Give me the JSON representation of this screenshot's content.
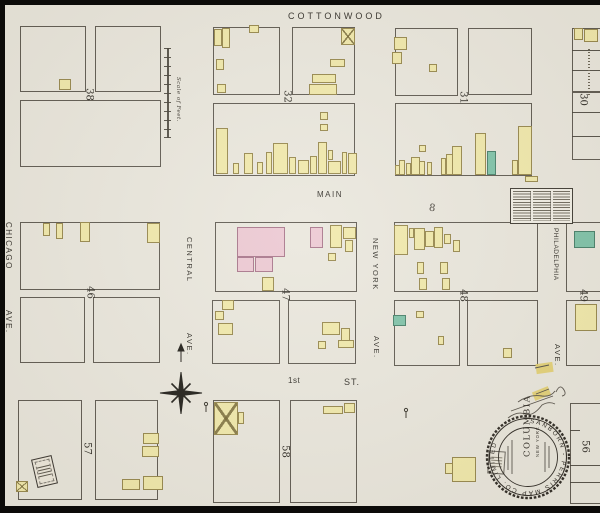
{
  "map": {
    "streets": {
      "cottonwood": "COTTONWOOD",
      "main": "MAIN",
      "first_number": "1st",
      "first_st": "ST.",
      "chicago": "CHICAGO",
      "chicago_ave": "AVE.",
      "central": "CENTRAL",
      "central_ave": "AVE.",
      "new_york": "NEW YORK",
      "new_york_ave": "AVE.",
      "philadelphia": "PHILADELPHIA",
      "philadelphia_ave": "AVE."
    },
    "scale_label": "Scale of Feet.",
    "stamp": {
      "ring_text": "SANBORN - PERRIS MAP CO. LIMITED",
      "city": "COLUMBIA",
      "sub": "NEW YORK"
    },
    "annotations": {
      "mark_eight": "8"
    },
    "colors": {
      "paper": "#eae7dd",
      "building_yellow": "#f1e9ab",
      "building_pink": "#ecc8d2",
      "building_green": "#7fc3a9",
      "line": "#46413a"
    },
    "block_numbers": [
      {
        "label": "38",
        "x": 82,
        "y": 89
      },
      {
        "label": "32",
        "x": 280,
        "y": 91
      },
      {
        "label": "31",
        "x": 456,
        "y": 92
      },
      {
        "label": "30",
        "x": 576,
        "y": 94
      },
      {
        "label": "46",
        "x": 83,
        "y": 287
      },
      {
        "label": "47",
        "x": 278,
        "y": 289
      },
      {
        "label": "48",
        "x": 456,
        "y": 290
      },
      {
        "label": "49",
        "x": 576,
        "y": 290
      },
      {
        "label": "57",
        "x": 80,
        "y": 443
      },
      {
        "label": "58",
        "x": 278,
        "y": 446
      },
      {
        "label": "56",
        "x": 578,
        "y": 441
      }
    ],
    "lots": [
      {
        "x": 20,
        "y": 26,
        "w": 66,
        "h": 66
      },
      {
        "x": 95,
        "y": 26,
        "w": 66,
        "h": 66
      },
      {
        "x": 20,
        "y": 100,
        "w": 141,
        "h": 67
      },
      {
        "x": 213,
        "y": 27,
        "w": 67,
        "h": 68
      },
      {
        "x": 292,
        "y": 27,
        "w": 63,
        "h": 68
      },
      {
        "x": 213,
        "y": 103,
        "w": 142,
        "h": 73
      },
      {
        "x": 395,
        "y": 28,
        "w": 63,
        "h": 68
      },
      {
        "x": 468,
        "y": 28,
        "w": 64,
        "h": 67
      },
      {
        "x": 395,
        "y": 103,
        "w": 137,
        "h": 73
      },
      {
        "x": 572,
        "y": 28,
        "w": 34,
        "h": 64
      },
      {
        "x": 572,
        "y": 92,
        "w": 34,
        "h": 68
      },
      {
        "x": 20,
        "y": 222,
        "w": 140,
        "h": 68
      },
      {
        "x": 20,
        "y": 297,
        "w": 65,
        "h": 66
      },
      {
        "x": 93,
        "y": 297,
        "w": 67,
        "h": 66
      },
      {
        "x": 215,
        "y": 222,
        "w": 142,
        "h": 70
      },
      {
        "x": 212,
        "y": 300,
        "w": 68,
        "h": 64
      },
      {
        "x": 288,
        "y": 300,
        "w": 68,
        "h": 64
      },
      {
        "x": 394,
        "y": 222,
        "w": 144,
        "h": 70
      },
      {
        "x": 394,
        "y": 300,
        "w": 66,
        "h": 66
      },
      {
        "x": 467,
        "y": 300,
        "w": 71,
        "h": 66
      },
      {
        "x": 566,
        "y": 222,
        "w": 40,
        "h": 70
      },
      {
        "x": 566,
        "y": 300,
        "w": 40,
        "h": 66
      },
      {
        "x": 18,
        "y": 400,
        "w": 64,
        "h": 100
      },
      {
        "x": 95,
        "y": 400,
        "w": 63,
        "h": 100
      },
      {
        "x": 213,
        "y": 400,
        "w": 67,
        "h": 103
      },
      {
        "x": 290,
        "y": 400,
        "w": 67,
        "h": 103
      },
      {
        "x": 570,
        "y": 403,
        "w": 36,
        "h": 101
      }
    ],
    "lines": [
      {
        "x": 167,
        "y": 48,
        "w": 2,
        "h": 90
      },
      {
        "x": 164,
        "y": 48,
        "w": 7,
        "h": 1
      },
      {
        "x": 164,
        "y": 57,
        "w": 7,
        "h": 1
      },
      {
        "x": 164,
        "y": 66,
        "w": 7,
        "h": 1
      },
      {
        "x": 164,
        "y": 75,
        "w": 7,
        "h": 1
      },
      {
        "x": 164,
        "y": 84,
        "w": 7,
        "h": 1
      },
      {
        "x": 164,
        "y": 93,
        "w": 7,
        "h": 1
      },
      {
        "x": 164,
        "y": 102,
        "w": 7,
        "h": 1
      },
      {
        "x": 164,
        "y": 111,
        "w": 7,
        "h": 1
      },
      {
        "x": 164,
        "y": 120,
        "w": 7,
        "h": 1
      },
      {
        "x": 164,
        "y": 129,
        "w": 7,
        "h": 1
      },
      {
        "x": 164,
        "y": 137,
        "w": 7,
        "h": 1
      },
      {
        "x": 572,
        "y": 50,
        "w": 28,
        "h": 1
      },
      {
        "x": 572,
        "y": 70,
        "w": 28,
        "h": 1
      },
      {
        "x": 572,
        "y": 112,
        "w": 28,
        "h": 1
      },
      {
        "x": 572,
        "y": 136,
        "w": 28,
        "h": 1
      },
      {
        "x": 570,
        "y": 430,
        "w": 10,
        "h": 1
      },
      {
        "x": 570,
        "y": 465,
        "w": 30,
        "h": 1
      },
      {
        "x": 570,
        "y": 482,
        "w": 30,
        "h": 1
      }
    ],
    "buildings": [
      {
        "x": 59,
        "y": 79,
        "w": 12,
        "h": 11,
        "c": "y"
      },
      {
        "x": 214,
        "y": 29,
        "w": 8,
        "h": 17,
        "c": "y"
      },
      {
        "x": 222,
        "y": 28,
        "w": 8,
        "h": 20,
        "c": "y"
      },
      {
        "x": 249,
        "y": 25,
        "w": 10,
        "h": 8,
        "c": "y"
      },
      {
        "x": 216,
        "y": 59,
        "w": 8,
        "h": 11,
        "c": "y"
      },
      {
        "x": 217,
        "y": 84,
        "w": 9,
        "h": 9,
        "c": "y"
      },
      {
        "x": 341,
        "y": 28,
        "w": 14,
        "h": 17,
        "c": "y",
        "xm": true
      },
      {
        "x": 330,
        "y": 59,
        "w": 15,
        "h": 8,
        "c": "y"
      },
      {
        "x": 312,
        "y": 74,
        "w": 24,
        "h": 9,
        "c": "y"
      },
      {
        "x": 309,
        "y": 84,
        "w": 28,
        "h": 11,
        "c": "y"
      },
      {
        "x": 216,
        "y": 128,
        "w": 12,
        "h": 46,
        "c": "y"
      },
      {
        "x": 233,
        "y": 163,
        "w": 6,
        "h": 11,
        "c": "y"
      },
      {
        "x": 244,
        "y": 153,
        "w": 9,
        "h": 21,
        "c": "y"
      },
      {
        "x": 257,
        "y": 162,
        "w": 6,
        "h": 12,
        "c": "y"
      },
      {
        "x": 266,
        "y": 152,
        "w": 6,
        "h": 22,
        "c": "y"
      },
      {
        "x": 273,
        "y": 143,
        "w": 15,
        "h": 31,
        "c": "y"
      },
      {
        "x": 289,
        "y": 157,
        "w": 7,
        "h": 17,
        "c": "y"
      },
      {
        "x": 298,
        "y": 160,
        "w": 11,
        "h": 14,
        "c": "y"
      },
      {
        "x": 310,
        "y": 156,
        "w": 7,
        "h": 18,
        "c": "y"
      },
      {
        "x": 318,
        "y": 142,
        "w": 9,
        "h": 32,
        "c": "y"
      },
      {
        "x": 328,
        "y": 150,
        "w": 5,
        "h": 10,
        "c": "y"
      },
      {
        "x": 328,
        "y": 161,
        "w": 13,
        "h": 13,
        "c": "y"
      },
      {
        "x": 342,
        "y": 152,
        "w": 5,
        "h": 22,
        "c": "y"
      },
      {
        "x": 348,
        "y": 153,
        "w": 9,
        "h": 21,
        "c": "y"
      },
      {
        "x": 320,
        "y": 112,
        "w": 8,
        "h": 8,
        "c": "y"
      },
      {
        "x": 320,
        "y": 124,
        "w": 8,
        "h": 7,
        "c": "y"
      },
      {
        "x": 394,
        "y": 37,
        "w": 13,
        "h": 13,
        "c": "y"
      },
      {
        "x": 392,
        "y": 52,
        "w": 10,
        "h": 12,
        "c": "y"
      },
      {
        "x": 429,
        "y": 64,
        "w": 8,
        "h": 8,
        "c": "y"
      },
      {
        "x": 395,
        "y": 165,
        "w": 6,
        "h": 10,
        "c": "y"
      },
      {
        "x": 399,
        "y": 160,
        "w": 6,
        "h": 15,
        "c": "y"
      },
      {
        "x": 406,
        "y": 163,
        "w": 5,
        "h": 12,
        "c": "y"
      },
      {
        "x": 411,
        "y": 157,
        "w": 9,
        "h": 18,
        "c": "y"
      },
      {
        "x": 419,
        "y": 161,
        "w": 6,
        "h": 14,
        "c": "y"
      },
      {
        "x": 419,
        "y": 145,
        "w": 7,
        "h": 7,
        "c": "y"
      },
      {
        "x": 427,
        "y": 162,
        "w": 5,
        "h": 13,
        "c": "y"
      },
      {
        "x": 441,
        "y": 158,
        "w": 5,
        "h": 17,
        "c": "y"
      },
      {
        "x": 446,
        "y": 154,
        "w": 7,
        "h": 21,
        "c": "y"
      },
      {
        "x": 452,
        "y": 146,
        "w": 10,
        "h": 29,
        "c": "y"
      },
      {
        "x": 475,
        "y": 133,
        "w": 11,
        "h": 42,
        "c": "y"
      },
      {
        "x": 487,
        "y": 151,
        "w": 9,
        "h": 24,
        "c": "g"
      },
      {
        "x": 518,
        "y": 126,
        "w": 14,
        "h": 49,
        "c": "y"
      },
      {
        "x": 512,
        "y": 160,
        "w": 6,
        "h": 15,
        "c": "y"
      },
      {
        "x": 574,
        "y": 28,
        "w": 9,
        "h": 12,
        "c": "y"
      },
      {
        "x": 584,
        "y": 29,
        "w": 14,
        "h": 13,
        "c": "y"
      },
      {
        "x": 43,
        "y": 223,
        "w": 7,
        "h": 13,
        "c": "y"
      },
      {
        "x": 56,
        "y": 223,
        "w": 7,
        "h": 16,
        "c": "y"
      },
      {
        "x": 80,
        "y": 222,
        "w": 10,
        "h": 20,
        "c": "y"
      },
      {
        "x": 147,
        "y": 223,
        "w": 13,
        "h": 20,
        "c": "y"
      },
      {
        "x": 237,
        "y": 227,
        "w": 48,
        "h": 30,
        "c": "p"
      },
      {
        "x": 237,
        "y": 257,
        "w": 17,
        "h": 15,
        "c": "p"
      },
      {
        "x": 255,
        "y": 257,
        "w": 18,
        "h": 15,
        "c": "p"
      },
      {
        "x": 310,
        "y": 227,
        "w": 13,
        "h": 21,
        "c": "p"
      },
      {
        "x": 330,
        "y": 225,
        "w": 12,
        "h": 23,
        "c": "y"
      },
      {
        "x": 343,
        "y": 227,
        "w": 13,
        "h": 12,
        "c": "y"
      },
      {
        "x": 345,
        "y": 240,
        "w": 8,
        "h": 12,
        "c": "y"
      },
      {
        "x": 328,
        "y": 253,
        "w": 8,
        "h": 8,
        "c": "y"
      },
      {
        "x": 262,
        "y": 277,
        "w": 12,
        "h": 14,
        "c": "y"
      },
      {
        "x": 222,
        "y": 300,
        "w": 12,
        "h": 10,
        "c": "y"
      },
      {
        "x": 215,
        "y": 311,
        "w": 9,
        "h": 9,
        "c": "y"
      },
      {
        "x": 218,
        "y": 323,
        "w": 15,
        "h": 12,
        "c": "y"
      },
      {
        "x": 322,
        "y": 322,
        "w": 18,
        "h": 13,
        "c": "y"
      },
      {
        "x": 341,
        "y": 328,
        "w": 9,
        "h": 14,
        "c": "y"
      },
      {
        "x": 318,
        "y": 341,
        "w": 8,
        "h": 8,
        "c": "y"
      },
      {
        "x": 338,
        "y": 340,
        "w": 16,
        "h": 8,
        "c": "y"
      },
      {
        "x": 394,
        "y": 225,
        "w": 14,
        "h": 30,
        "c": "y"
      },
      {
        "x": 409,
        "y": 228,
        "w": 5,
        "h": 10,
        "c": "y"
      },
      {
        "x": 414,
        "y": 228,
        "w": 11,
        "h": 22,
        "c": "y"
      },
      {
        "x": 425,
        "y": 231,
        "w": 9,
        "h": 16,
        "c": "y"
      },
      {
        "x": 434,
        "y": 227,
        "w": 9,
        "h": 21,
        "c": "y"
      },
      {
        "x": 444,
        "y": 234,
        "w": 7,
        "h": 10,
        "c": "y"
      },
      {
        "x": 453,
        "y": 240,
        "w": 7,
        "h": 12,
        "c": "y"
      },
      {
        "x": 417,
        "y": 262,
        "w": 7,
        "h": 12,
        "c": "y"
      },
      {
        "x": 419,
        "y": 278,
        "w": 8,
        "h": 12,
        "c": "y"
      },
      {
        "x": 440,
        "y": 262,
        "w": 8,
        "h": 12,
        "c": "y"
      },
      {
        "x": 442,
        "y": 278,
        "w": 8,
        "h": 12,
        "c": "y"
      },
      {
        "x": 393,
        "y": 315,
        "w": 13,
        "h": 11,
        "c": "g"
      },
      {
        "x": 416,
        "y": 311,
        "w": 8,
        "h": 7,
        "c": "y"
      },
      {
        "x": 438,
        "y": 336,
        "w": 6,
        "h": 9,
        "c": "y"
      },
      {
        "x": 503,
        "y": 348,
        "w": 9,
        "h": 10,
        "c": "y"
      },
      {
        "x": 574,
        "y": 231,
        "w": 21,
        "h": 17,
        "c": "g"
      },
      {
        "x": 575,
        "y": 304,
        "w": 22,
        "h": 27,
        "c": "y"
      },
      {
        "x": 16,
        "y": 481,
        "w": 12,
        "h": 11,
        "c": "y",
        "xm": true
      },
      {
        "x": 143,
        "y": 433,
        "w": 16,
        "h": 11,
        "c": "y"
      },
      {
        "x": 142,
        "y": 446,
        "w": 17,
        "h": 11,
        "c": "y"
      },
      {
        "x": 143,
        "y": 476,
        "w": 20,
        "h": 14,
        "c": "y"
      },
      {
        "x": 122,
        "y": 479,
        "w": 18,
        "h": 11,
        "c": "y"
      },
      {
        "x": 214,
        "y": 402,
        "w": 24,
        "h": 33,
        "c": "y",
        "xm": true
      },
      {
        "x": 238,
        "y": 412,
        "w": 6,
        "h": 12,
        "c": "y"
      },
      {
        "x": 323,
        "y": 406,
        "w": 20,
        "h": 8,
        "c": "y"
      },
      {
        "x": 344,
        "y": 403,
        "w": 11,
        "h": 10,
        "c": "y"
      },
      {
        "x": 452,
        "y": 457,
        "w": 24,
        "h": 25,
        "c": "y"
      },
      {
        "x": 445,
        "y": 463,
        "w": 8,
        "h": 11,
        "c": "y"
      },
      {
        "x": 525,
        "y": 176,
        "w": 13,
        "h": 6,
        "c": "y"
      },
      {
        "x": 533,
        "y": 389,
        "w": 17,
        "h": 9,
        "c": "n",
        "r": -22
      },
      {
        "x": 536,
        "y": 363,
        "w": 17,
        "h": 10,
        "c": "n",
        "r": -8
      }
    ]
  }
}
